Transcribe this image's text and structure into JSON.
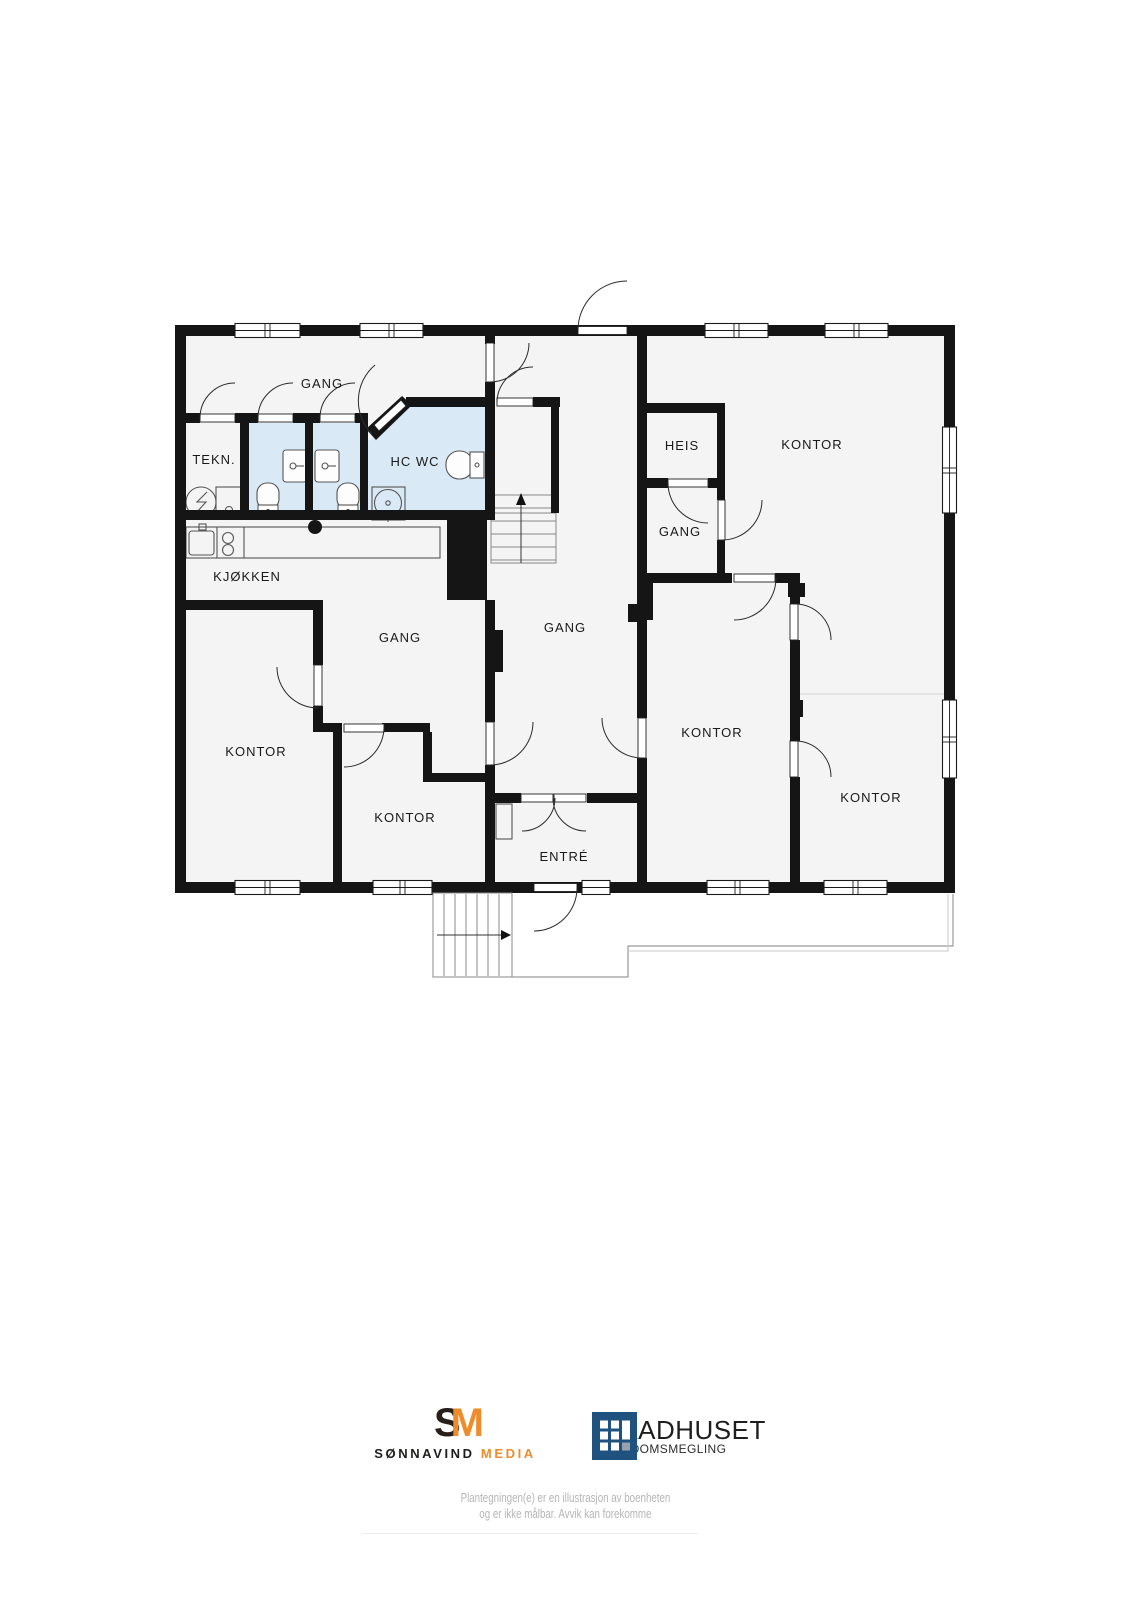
{
  "plan": {
    "rooms": [
      {
        "label": "GANG"
      },
      {
        "label": "TEKN."
      },
      {
        "label": "HC WC"
      },
      {
        "label": "KJØKKEN"
      },
      {
        "label": "GANG"
      },
      {
        "label": "GANG"
      },
      {
        "label": "HEIS"
      },
      {
        "label": "GANG"
      },
      {
        "label": "KONTOR"
      },
      {
        "label": "KONTOR"
      },
      {
        "label": "KONTOR"
      },
      {
        "label": "KONTOR"
      },
      {
        "label": "KONTOR"
      },
      {
        "label": "ENTRÉ"
      }
    ],
    "colors": {
      "wall": "#151515",
      "room_fill": "#f4f4f4",
      "wet_room_fill": "#d9eaf6"
    }
  },
  "footer": {
    "media_logo": {
      "mark_s": "S",
      "mark_m": "M",
      "name": "SØNNAVIND",
      "name_accent": "MEDIA",
      "accent_color": "#ee8c2b"
    },
    "broker_logo": {
      "name": "RAADHUSET",
      "subtitle": "EIENDOMSMEGLING",
      "square_color": "#20527f"
    },
    "disclaimer_line1": "Plantegningen(e) er en illustrasjon av boenheten",
    "disclaimer_line2": "og er ikke målbar. Avvik kan forekomme"
  }
}
